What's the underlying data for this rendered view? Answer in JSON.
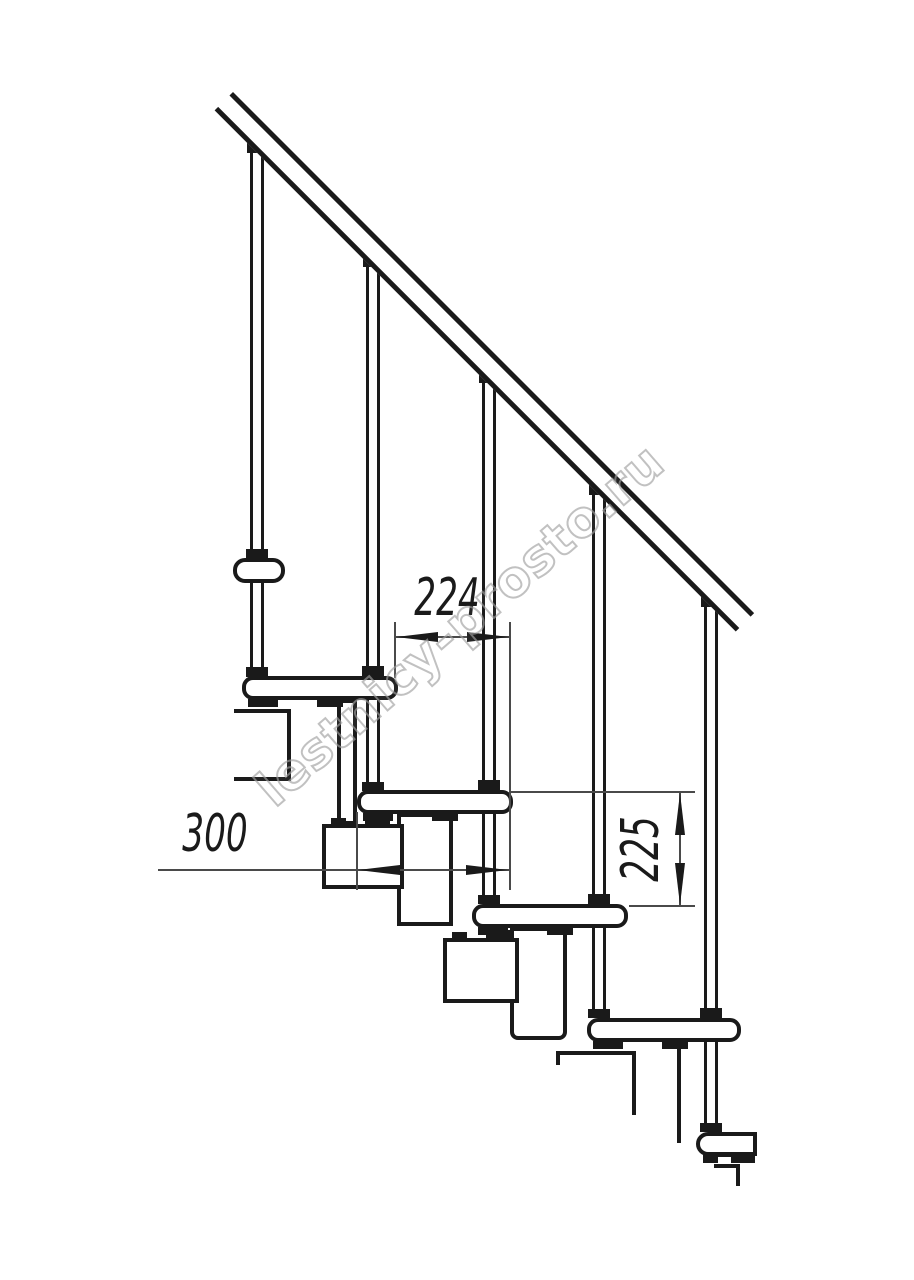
{
  "watermark": {
    "text": "lestnicy-prosto.ru"
  },
  "dimensions": {
    "step_run": {
      "label": "224"
    },
    "tread_depth": {
      "label": "300"
    },
    "step_rise": {
      "label": "225"
    }
  },
  "colors": {
    "line": "#1a1a1a",
    "dimension_line": "#4a4a4a",
    "watermark": "#a0a0a0",
    "background": "#ffffff"
  }
}
